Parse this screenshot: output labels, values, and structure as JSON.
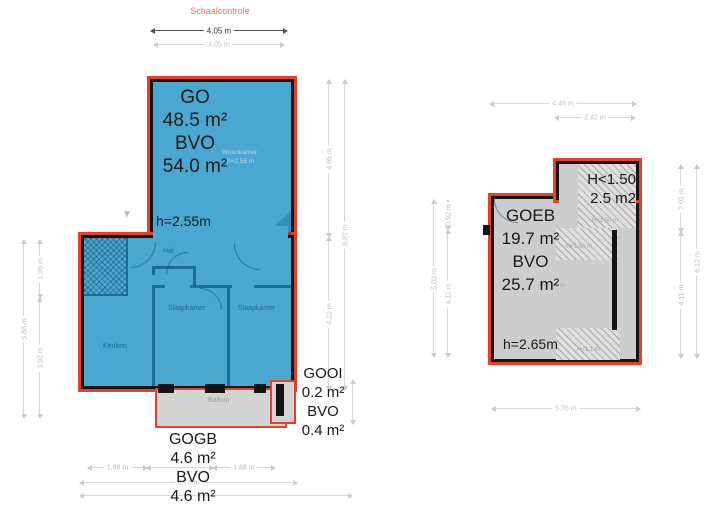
{
  "scale_check": {
    "label": "Schaalcontrole",
    "dim_primary": "4.05 m",
    "dim_secondary": "4.05 m"
  },
  "left_plan": {
    "title_block": [
      "GO",
      "48.5 m²",
      "BVO",
      "54.0 m²"
    ],
    "ceiling_height": "h=2.55m",
    "rooms": {
      "woonkamer_faint": "Woonkamer",
      "woonkamer_height_faint": "h=2.55 m",
      "hal": "Hal",
      "keuken": "Keuken",
      "slaapkamer_1": "Slaapkamer",
      "slaapkamer_2": "Slaapkamer",
      "balkon": "Balkon"
    },
    "balcony_block": [
      "GOGB",
      "4.6 m²",
      "BVO",
      "4.6 m²"
    ],
    "niche_block": [
      "GOOI",
      "0.2 m²",
      "BVO",
      "0.4 m²"
    ],
    "dims": {
      "left_outer": "5.88 m",
      "left_upper": "1.96 m",
      "left_lower": "3.92 m",
      "right_upper": "4.65 m",
      "right_lower": "4.22 m",
      "right_outer": "8.87 m",
      "bottom_left_segment": "1.88 m",
      "bottom_right_segment": "1.88 m",
      "bottom_total": "6.74 m"
    }
  },
  "right_plan": {
    "low_height_block": [
      "H<1.50",
      "2.5 m2"
    ],
    "title_block": [
      "GOEB",
      "19.7 m²",
      "BVO",
      "25.7 m²"
    ],
    "ceiling_height": "h=2.65m",
    "ceiling_height_faint": "h=2.65 m",
    "hatch_labels": [
      "H<1.50 m",
      "H<1.50 m",
      "H<1.1 m"
    ],
    "dims": {
      "top_total": "4.46 m",
      "top_partial": "2.42 m",
      "left_outer": "5.03 m",
      "left_upper": "0.92 m",
      "left_lower": "4.11 m",
      "right_upper": "2.01 m",
      "right_lower": "4.11 m",
      "right_outer": "6.12 m",
      "bottom": "5.76 m"
    }
  },
  "icons": {
    "entrance_marker": "▼"
  },
  "colors": {
    "plan_fill_blue": "#49a7d0",
    "plan_fill_gray": "#cdcdcd",
    "outline_red": "#e6402a",
    "wall_black": "#141414",
    "interior_wall_blue": "#1b6d96",
    "dim_gray": "#c9c9c9",
    "scale_label_red": "#e0756b",
    "label_text": "#1a1a1a"
  }
}
